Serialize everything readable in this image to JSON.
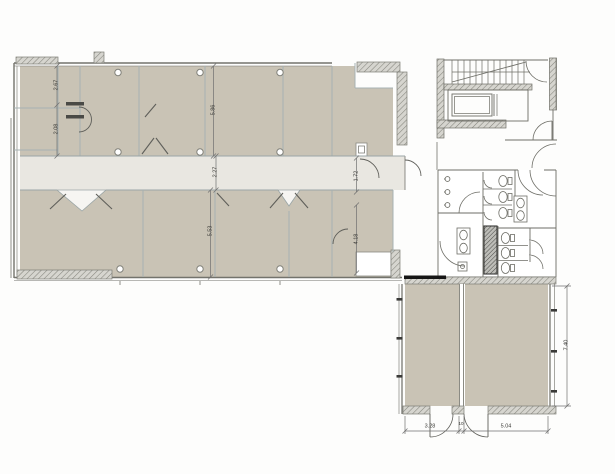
{
  "plan": {
    "dimensions": {
      "main_left_upper": "2.67",
      "main_left_lower": "2.08",
      "main_top_room_depth": "5.86",
      "corridor_width": "2.27",
      "main_bottom_room_depth": "5.53",
      "vestibule_width": "1.72",
      "right_room_depth": "4.18",
      "annex_left_width": "3.28",
      "annex_mid_gap": "10",
      "annex_right_width": "5.04",
      "annex_depth": "7.40"
    },
    "colors": {
      "room_fill": "#c9c3b5",
      "corridor_fill": "#e9e7e1",
      "lobby_fill": "#f6f5f2",
      "wall": "#73736c",
      "partition": "#a6b2b3",
      "hatch": "#85857d",
      "accent_black": "#161616"
    }
  }
}
